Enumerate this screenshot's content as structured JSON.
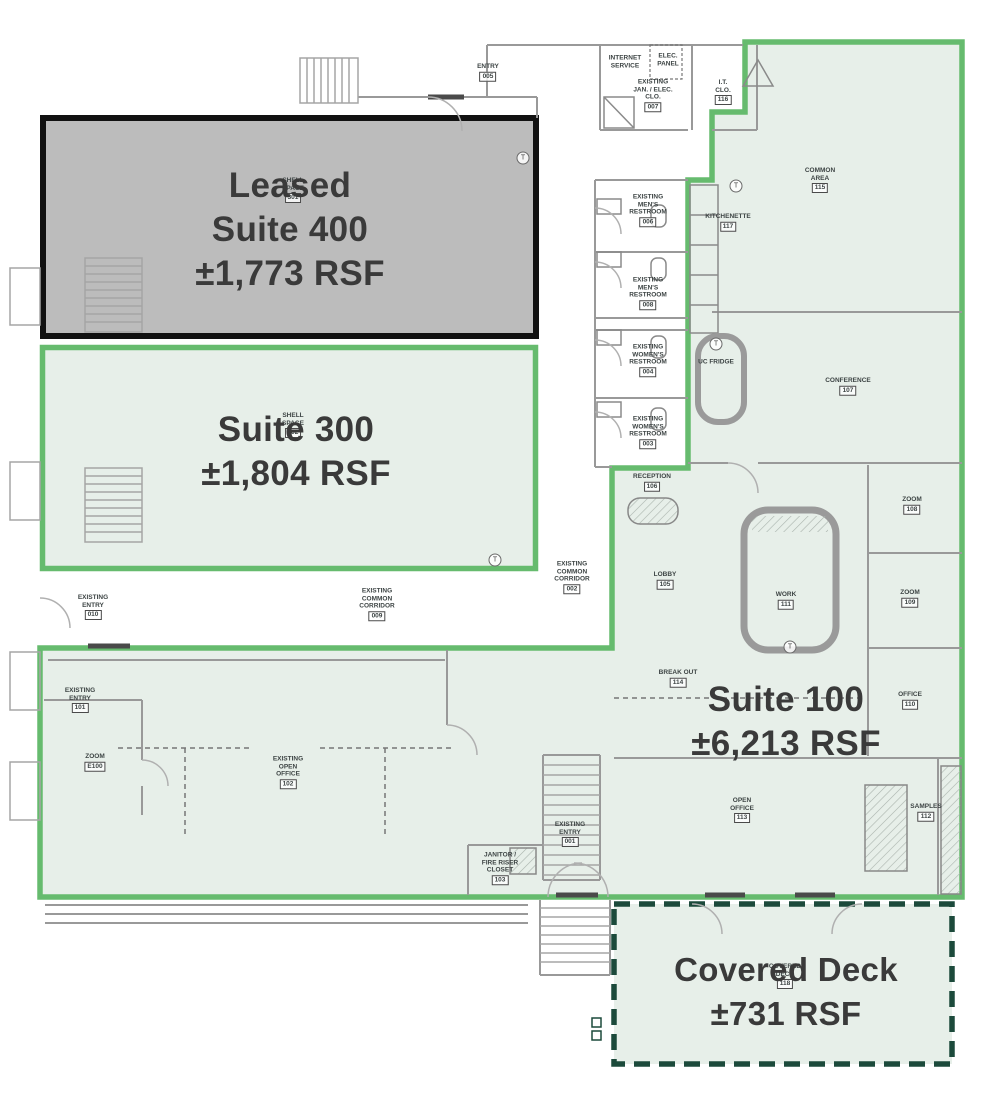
{
  "title": "Office floor plan with leasing suite overlays",
  "colors": {
    "available_fill": "#e7efe9",
    "available_border": "#66bb6e",
    "leased_fill": "#bcbcbc",
    "leased_border": "#111111",
    "deck_border": "#1c4a3b",
    "wall": "#999999",
    "label_text": "#3a3a3a"
  },
  "suites": {
    "suite400": {
      "lines": [
        "Leased",
        "Suite 400",
        "±1,773 RSF"
      ]
    },
    "suite300": {
      "lines": [
        "Suite 300",
        "±1,804 RSF"
      ]
    },
    "suite100": {
      "lines": [
        "Suite 100",
        "±6,213 RSF"
      ]
    },
    "deck": {
      "lines": [
        "Covered Deck",
        "±731 RSF"
      ]
    }
  },
  "marker_symbol": "T",
  "t_markers": [
    {
      "x": 523,
      "y": 158
    },
    {
      "x": 736,
      "y": 186
    },
    {
      "x": 716,
      "y": 344
    },
    {
      "x": 495,
      "y": 560
    },
    {
      "x": 790,
      "y": 647
    }
  ],
  "rooms": [
    {
      "lines": [
        "ENTRY"
      ],
      "number": "005",
      "x": 488,
      "y": 72
    },
    {
      "lines": [
        "INTERNET",
        "SERVICE"
      ],
      "x": 625,
      "y": 62
    },
    {
      "lines": [
        "ELEC.",
        "PANEL"
      ],
      "x": 668,
      "y": 60
    },
    {
      "lines": [
        "EXISTING",
        "JAN. / ELEC.",
        "CLO."
      ],
      "number": "007",
      "x": 653,
      "y": 95
    },
    {
      "lines": [
        "I.T.",
        "CLO."
      ],
      "number": "116",
      "x": 723,
      "y": 92
    },
    {
      "lines": [
        "COMMON",
        "AREA"
      ],
      "number": "115",
      "x": 820,
      "y": 180
    },
    {
      "lines": [
        "KITCHENETTE"
      ],
      "number": "117",
      "x": 728,
      "y": 222
    },
    {
      "lines": [
        "EXISTING",
        "MEN'S",
        "RESTROOM"
      ],
      "number": "006",
      "x": 648,
      "y": 210
    },
    {
      "lines": [
        "EXISTING",
        "MEN'S",
        "RESTROOM"
      ],
      "number": "008",
      "x": 648,
      "y": 293
    },
    {
      "lines": [
        "EXISTING",
        "WOMEN'S",
        "RESTROOM"
      ],
      "number": "004",
      "x": 648,
      "y": 360
    },
    {
      "lines": [
        "EXISTING",
        "WOMEN'S",
        "RESTROOM"
      ],
      "number": "003",
      "x": 648,
      "y": 432
    },
    {
      "lines": [
        "UC FRIDGE"
      ],
      "x": 716,
      "y": 362
    },
    {
      "lines": [
        "CONFERENCE"
      ],
      "number": "107",
      "x": 848,
      "y": 386
    },
    {
      "lines": [
        "RECEPTION"
      ],
      "number": "106",
      "x": 652,
      "y": 482
    },
    {
      "lines": [
        "LOBBY"
      ],
      "number": "105",
      "x": 665,
      "y": 580
    },
    {
      "lines": [
        "WORK"
      ],
      "number": "111",
      "x": 786,
      "y": 600
    },
    {
      "lines": [
        "ZOOM"
      ],
      "number": "108",
      "x": 912,
      "y": 505
    },
    {
      "lines": [
        "ZOOM"
      ],
      "number": "109",
      "x": 910,
      "y": 598
    },
    {
      "lines": [
        "BREAK OUT"
      ],
      "number": "114",
      "x": 678,
      "y": 678
    },
    {
      "lines": [
        "OFFICE"
      ],
      "number": "110",
      "x": 910,
      "y": 700
    },
    {
      "lines": [
        "OPEN",
        "OFFICE"
      ],
      "number": "113",
      "x": 742,
      "y": 810
    },
    {
      "lines": [
        "SAMPLES"
      ],
      "number": "112",
      "x": 926,
      "y": 812
    },
    {
      "lines": [
        "EXISTING",
        "ENTRY"
      ],
      "number": "010",
      "x": 93,
      "y": 607
    },
    {
      "lines": [
        "EXISTING",
        "ENTRY"
      ],
      "number": "101",
      "x": 80,
      "y": 700
    },
    {
      "lines": [
        "ZOOM"
      ],
      "number": "E100",
      "x": 95,
      "y": 762
    },
    {
      "lines": [
        "EXISTING",
        "OPEN",
        "OFFICE"
      ],
      "number": "102",
      "x": 288,
      "y": 772
    },
    {
      "lines": [
        "JANITOR /",
        "FIRE RISER",
        "CLOSET"
      ],
      "number": "103",
      "x": 500,
      "y": 868
    },
    {
      "lines": [
        "EXISTING",
        "ENTRY"
      ],
      "number": "001",
      "x": 570,
      "y": 834
    },
    {
      "lines": [
        "EXISTING",
        "COMMON",
        "CORRIDOR"
      ],
      "number": "009",
      "x": 377,
      "y": 604
    },
    {
      "lines": [
        "EXISTING",
        "COMMON",
        "CORRIDOR"
      ],
      "number": "002",
      "x": 572,
      "y": 577
    },
    {
      "lines": [
        "SHELL",
        "SPACE"
      ],
      "number": "301",
      "x": 293,
      "y": 190
    },
    {
      "lines": [
        "SHELL",
        "SPACE"
      ],
      "number": "302",
      "x": 293,
      "y": 425
    },
    {
      "lines": [
        "COVERED",
        "DECK"
      ],
      "number": "118",
      "x": 785,
      "y": 976
    }
  ]
}
